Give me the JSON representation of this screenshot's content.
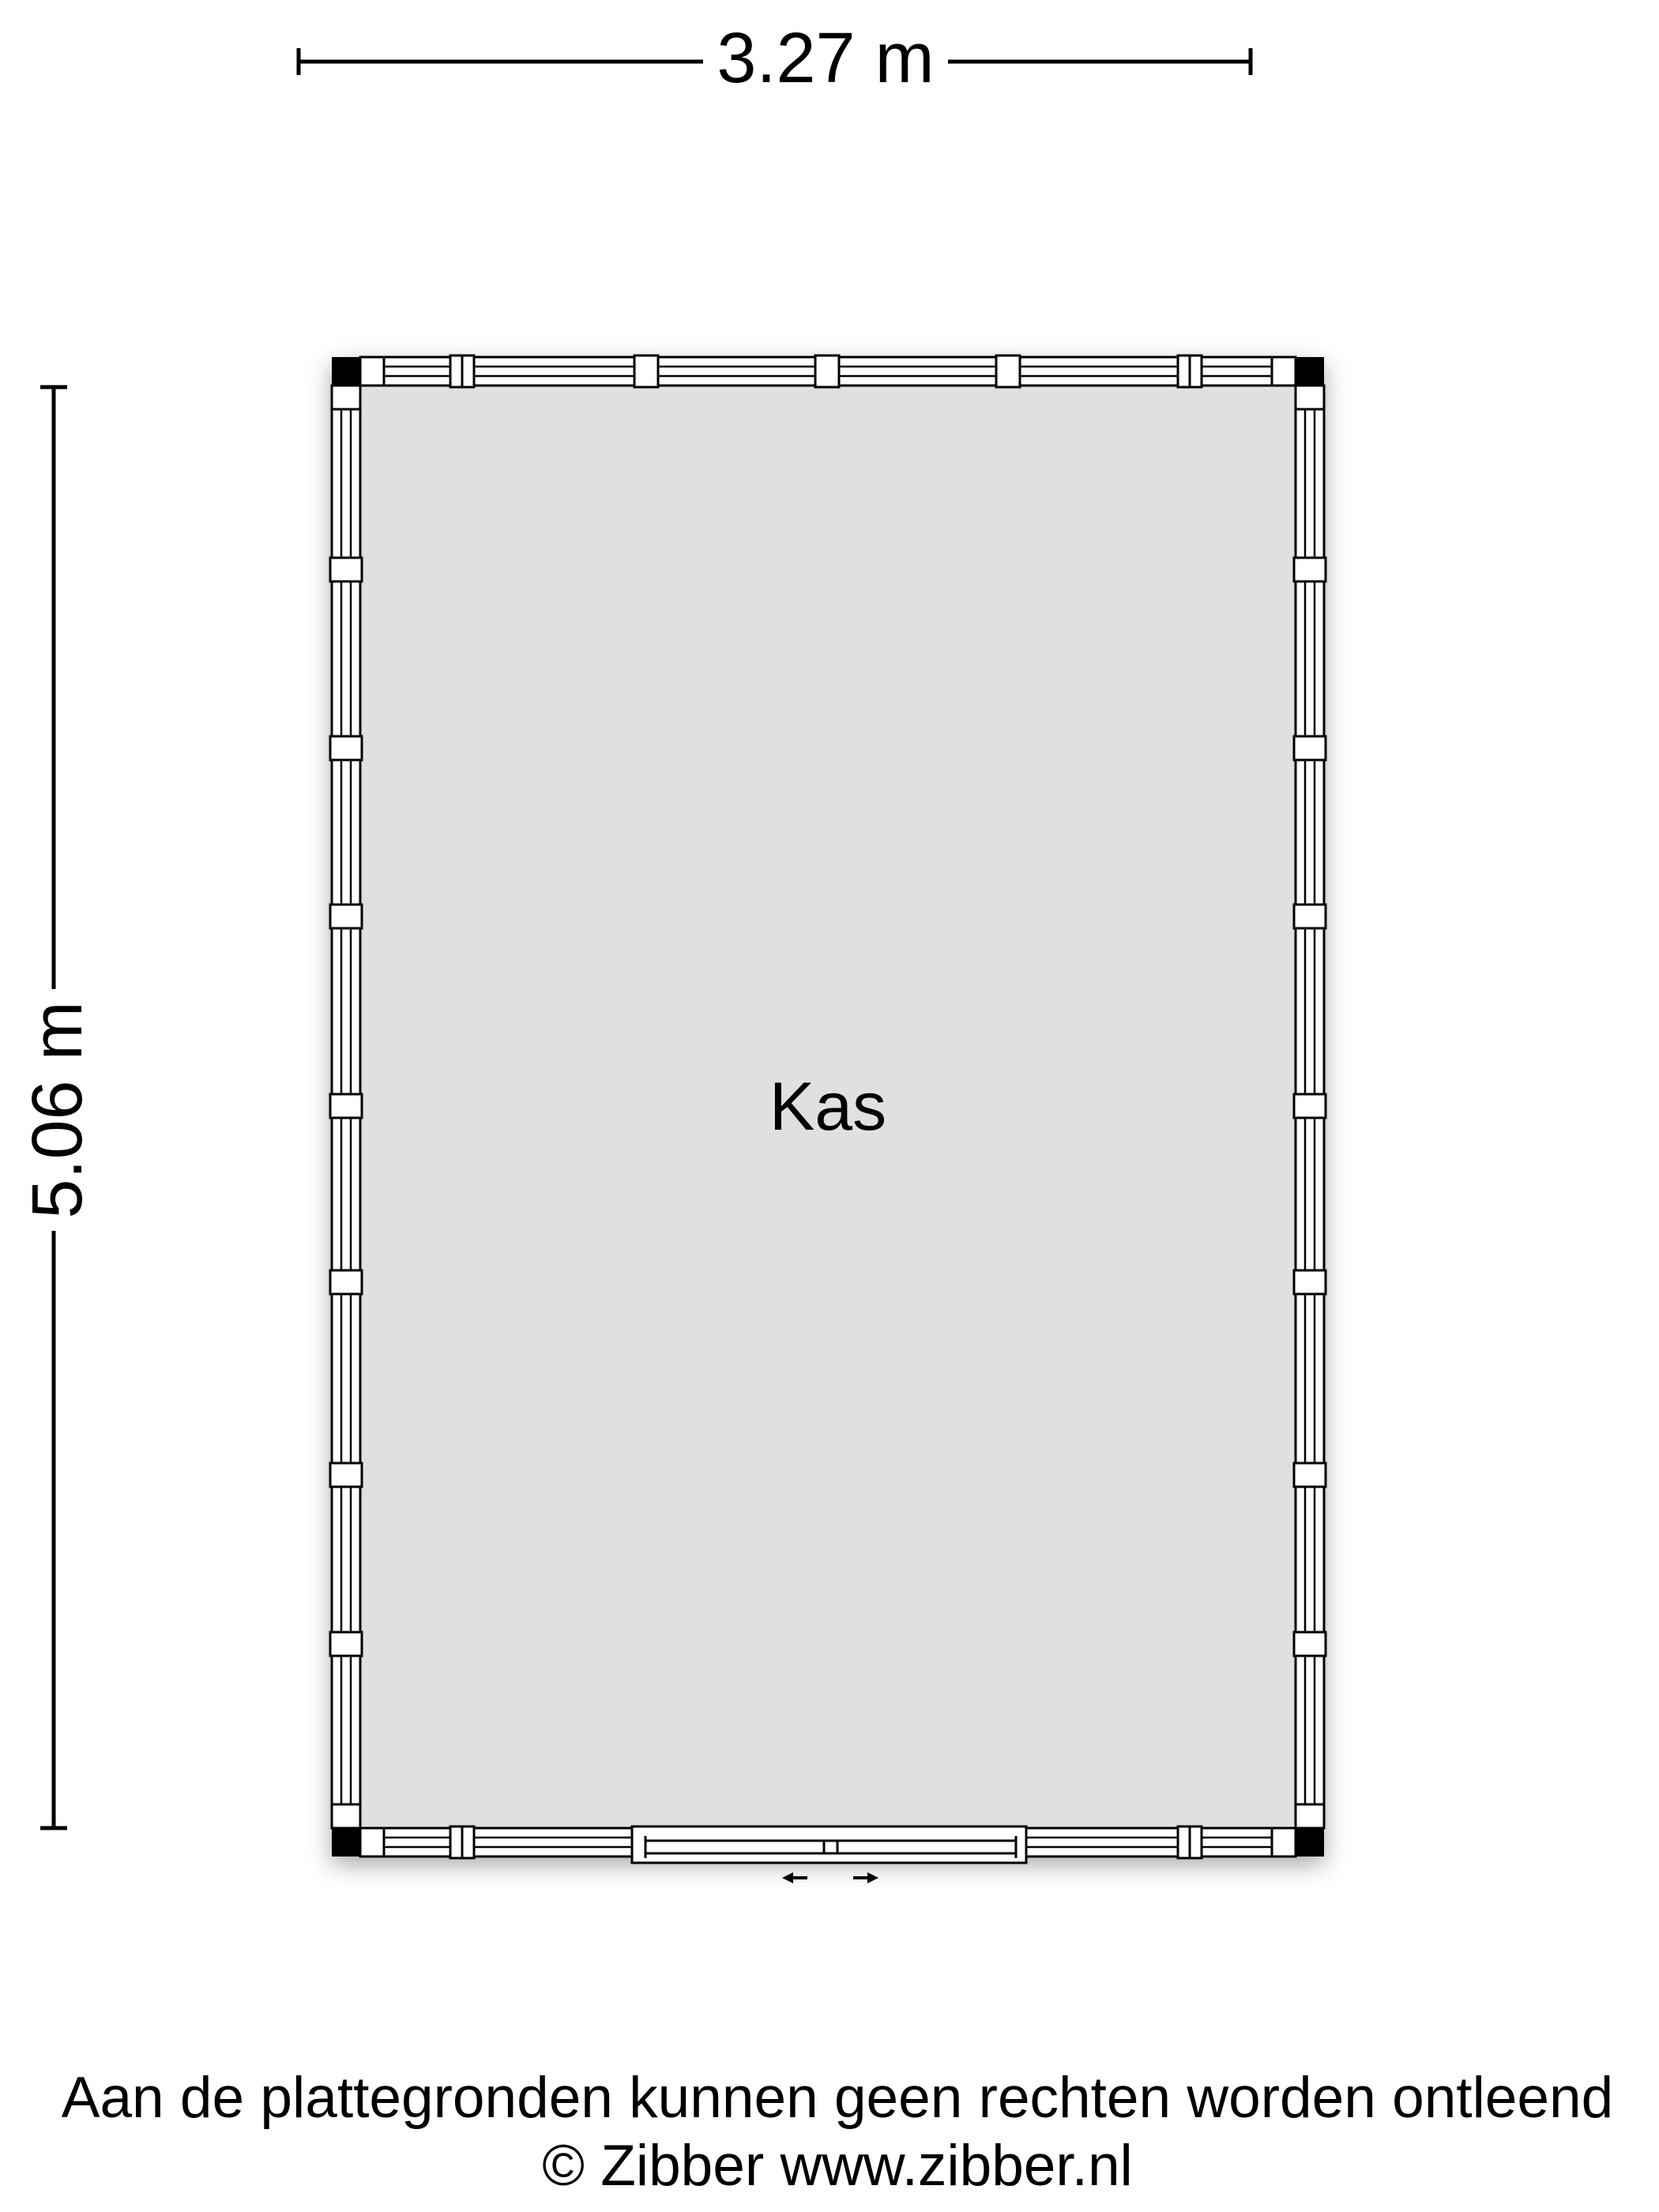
{
  "floorplan": {
    "room": {
      "label": "Kas"
    },
    "dimensions": {
      "width": {
        "label": "3.27 m"
      },
      "height": {
        "label": "5.06 m"
      }
    },
    "colors": {
      "floor": "#e0e0e0",
      "wall_fill": "#ffffff",
      "line": "#000000",
      "corner": "#000000",
      "background": "#ffffff"
    }
  },
  "footer": {
    "disclaimer": "Aan de plattegronden kunnen geen rechten worden ontleend",
    "copyright": "© Zibber www.zibber.nl"
  }
}
